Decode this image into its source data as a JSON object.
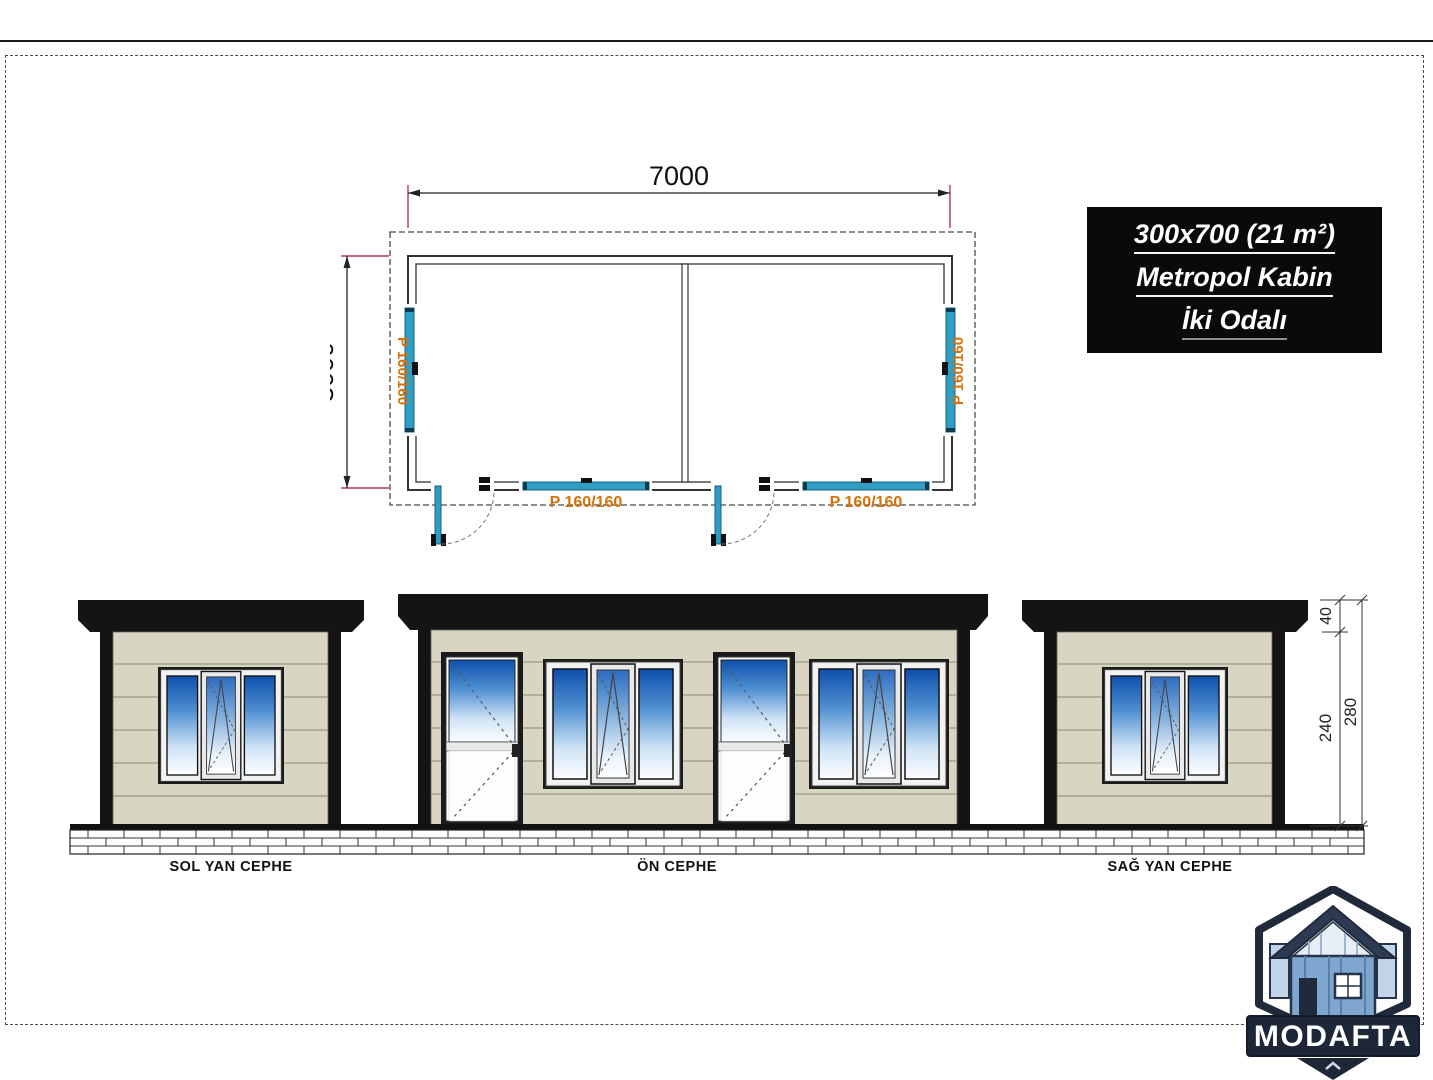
{
  "page": {
    "background": "#ffffff",
    "border_color": "#4a4a4a"
  },
  "title_block": {
    "bg": "#0a0a0a",
    "text_color": "#ffffff",
    "lines": [
      "300x700 (21 m²)",
      "Metropol Kabin",
      "İki Odalı"
    ]
  },
  "floor_plan": {
    "width_dim": "7000",
    "height_dim": "3000",
    "window_labels": {
      "left": "P 160/160",
      "right": "P 160/160",
      "bottom_left": "P 160/160",
      "bottom_right": "P 160/160"
    }
  },
  "elevations": {
    "left_label": "SOL YAN CEPHE",
    "front_label": "ÖN CEPHE",
    "right_label": "SAĞ YAN CEPHE",
    "dimensions": {
      "roof_height": "40",
      "wall_height": "240",
      "total_height": "280"
    }
  },
  "logo": {
    "text": "MODAFTA"
  },
  "colors": {
    "window_plan_teal": "#2F9DC4",
    "label_orange": "#D5720B",
    "dim_red": "#B43A52",
    "siding_beige": "#D8D5C3",
    "roof_black": "#141414",
    "glass_blue": "#0F4FAE",
    "logo_navy": "#1D2738"
  }
}
